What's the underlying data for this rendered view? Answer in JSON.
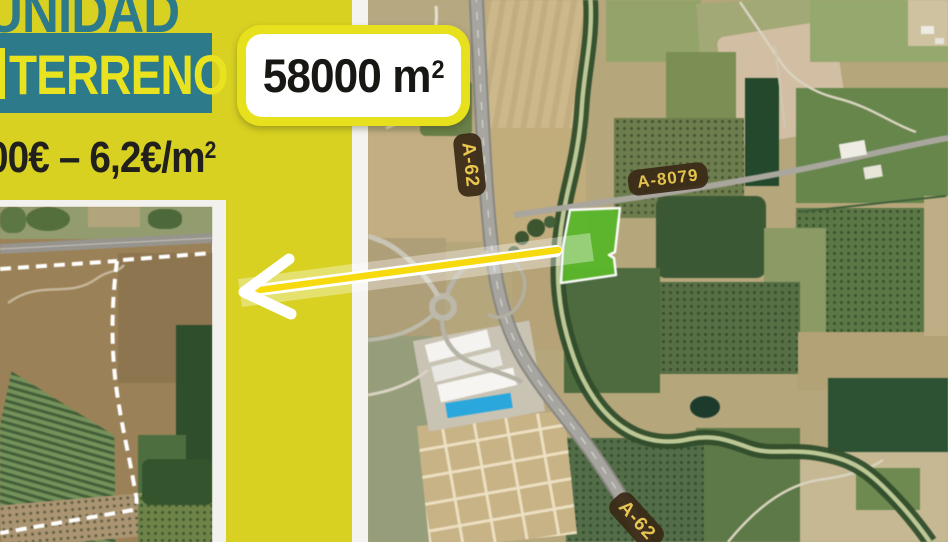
{
  "panel": {
    "headline_fragment": "UNIDAD",
    "banner_fragment": "TERRENO",
    "price_fragment": "00€ – 6,2€/m",
    "price_sup": "2"
  },
  "area_badge": {
    "value": "58000 m",
    "unit_sup": "2"
  },
  "map": {
    "road_labels": [
      {
        "id": "a62-top",
        "text": "A-62"
      },
      {
        "id": "a8079",
        "text": "A-8079"
      },
      {
        "id": "a62-bottom",
        "text": "A-62"
      }
    ],
    "highlighted_plot": "plot-for-sale"
  },
  "colors": {
    "panel_yellow": "#d8d122",
    "teal": "#2d7a8b",
    "banner_text_yellow": "#e9e31f",
    "badge_ring_yellow": "#e7e01c",
    "plot_green": "#5ab62b",
    "arrow_yellow": "#f6da0e",
    "label_bg_brown": "#3a2a16",
    "label_text_gold": "#ecc94e"
  }
}
